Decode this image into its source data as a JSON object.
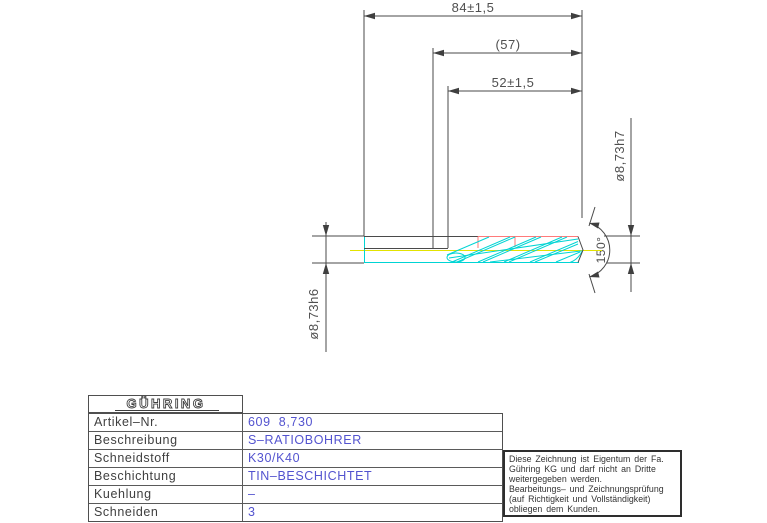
{
  "drawing": {
    "dim_total_length": "84±1,5",
    "dim_ref_length": "(57)",
    "dim_flute_length": "52±1,5",
    "dim_cut_diameter": "ø8,73h7",
    "dim_shank_diameter": "ø8,73h6",
    "dim_point_angle": "150°"
  },
  "titleblock": {
    "logo": "GÜHRING",
    "rows": [
      {
        "label": "Artikel–Nr.",
        "value": "609  8,730"
      },
      {
        "label": "Beschreibung",
        "value": "S–RATIOBOHRER"
      },
      {
        "label": "Schneidstoff",
        "value": "K30/K40"
      },
      {
        "label": "Beschichtung",
        "value": "TIN–BESCHICHTET"
      },
      {
        "label": "Kuehlung",
        "value": "–"
      },
      {
        "label": "Schneiden",
        "value": "3"
      }
    ]
  },
  "disclaimer": {
    "lines": [
      "Diese Zeichnung ist Eigentum der Fa.",
      "Gühring KG und darf nicht an Dritte",
      "weitergegeben werden.",
      "Bearbeitungs– und Zeichnungsprüfung",
      "(auf Richtigkeit und Vollständigkeit)",
      "obliegen dem Kunden."
    ]
  },
  "colors": {
    "line": "#4a4a4a",
    "flute_cyan": "#00d4d4",
    "centerline_yellow": "#e3e300",
    "highlight_red": "#ff7a7a",
    "value_blue": "#5353cf"
  }
}
